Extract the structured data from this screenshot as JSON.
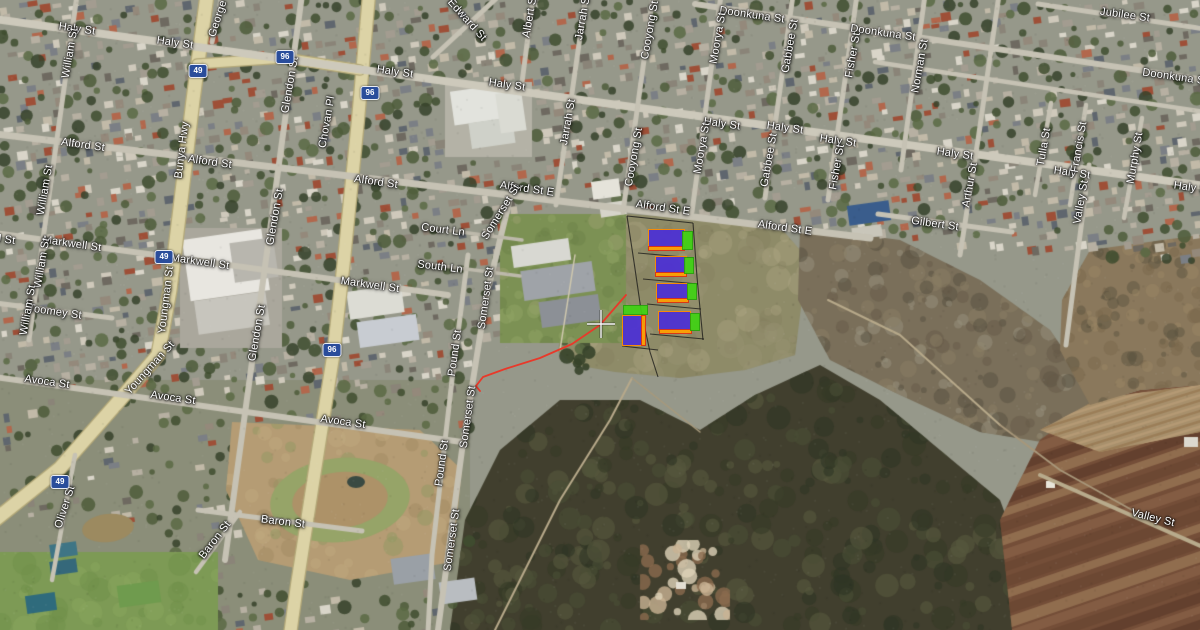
{
  "map": {
    "view": "satellite",
    "street_labels": [
      {
        "text": "Haly St",
        "x": 77,
        "y": 29,
        "rot": 8
      },
      {
        "text": "Haly St",
        "x": 175,
        "y": 43,
        "rot": 8
      },
      {
        "text": "Haly St",
        "x": 395,
        "y": 72,
        "rot": 8
      },
      {
        "text": "Haly St",
        "x": 507,
        "y": 85,
        "rot": 8
      },
      {
        "text": "Haly St",
        "x": 722,
        "y": 124,
        "rot": 8
      },
      {
        "text": "Haly St",
        "x": 785,
        "y": 128,
        "rot": 8
      },
      {
        "text": "Haly St",
        "x": 838,
        "y": 141,
        "rot": 8
      },
      {
        "text": "Haly St",
        "x": 955,
        "y": 154,
        "rot": 8
      },
      {
        "text": "Haly St",
        "x": 1072,
        "y": 173,
        "rot": 8
      },
      {
        "text": "Haly St",
        "x": 1192,
        "y": 188,
        "rot": 8
      },
      {
        "text": "Alford St",
        "x": 83,
        "y": 145,
        "rot": 8
      },
      {
        "text": "Alford St",
        "x": 210,
        "y": 162,
        "rot": 8
      },
      {
        "text": "Alford St",
        "x": 376,
        "y": 182,
        "rot": 8
      },
      {
        "text": "Alford St E",
        "x": 527,
        "y": 189,
        "rot": 8
      },
      {
        "text": "Alford St E",
        "x": 663,
        "y": 208,
        "rot": 8
      },
      {
        "text": "Alford St E",
        "x": 785,
        "y": 228,
        "rot": 8
      },
      {
        "text": "Markwell St",
        "x": -14,
        "y": 237,
        "rot": 8
      },
      {
        "text": "Markwell St",
        "x": 72,
        "y": 244,
        "rot": 8
      },
      {
        "text": "Markwell St",
        "x": 200,
        "y": 262,
        "rot": 8
      },
      {
        "text": "Markwell St",
        "x": 370,
        "y": 285,
        "rot": 8
      },
      {
        "text": "Avoca St",
        "x": 47,
        "y": 382,
        "rot": 8
      },
      {
        "text": "Avoca St",
        "x": 173,
        "y": 398,
        "rot": 8
      },
      {
        "text": "Avoca St",
        "x": 343,
        "y": 422,
        "rot": 8
      },
      {
        "text": "Doonkuna St",
        "x": 752,
        "y": 15,
        "rot": 8
      },
      {
        "text": "Doonkuna St",
        "x": 883,
        "y": 33,
        "rot": 8
      },
      {
        "text": "Doonkuna St",
        "x": 1175,
        "y": 77,
        "rot": 8
      },
      {
        "text": "Jubilee St",
        "x": 1125,
        "y": 15,
        "rot": 8
      },
      {
        "text": "Gilbert St",
        "x": 935,
        "y": 224,
        "rot": 8
      },
      {
        "text": "Court Ln",
        "x": 443,
        "y": 230,
        "rot": 7
      },
      {
        "text": "South Ln",
        "x": 440,
        "y": 267,
        "rot": 7
      },
      {
        "text": "Toomey St",
        "x": 55,
        "y": 312,
        "rot": 8
      },
      {
        "text": "Baron St",
        "x": 283,
        "y": 522,
        "rot": 7
      },
      {
        "text": "Baron St",
        "x": 215,
        "y": 540,
        "rot": -52
      },
      {
        "text": "William St",
        "x": 70,
        "y": 53,
        "rot": -80
      },
      {
        "text": "William St",
        "x": 45,
        "y": 190,
        "rot": -80
      },
      {
        "text": "William St",
        "x": 42,
        "y": 263,
        "rot": -80
      },
      {
        "text": "William St",
        "x": 28,
        "y": 310,
        "rot": -80
      },
      {
        "text": "Glendon St",
        "x": 290,
        "y": 85,
        "rot": -80
      },
      {
        "text": "Glendon St",
        "x": 275,
        "y": 217,
        "rot": -80
      },
      {
        "text": "Glendon St",
        "x": 257,
        "y": 333,
        "rot": -80
      },
      {
        "text": "Chovan Pl",
        "x": 327,
        "y": 122,
        "rot": -80
      },
      {
        "text": "Somerset St",
        "x": 501,
        "y": 212,
        "rot": -58
      },
      {
        "text": "Somerset St",
        "x": 486,
        "y": 298,
        "rot": -82
      },
      {
        "text": "Somerset St",
        "x": 468,
        "y": 417,
        "rot": -82
      },
      {
        "text": "Somerset St",
        "x": 452,
        "y": 540,
        "rot": -82
      },
      {
        "text": "Pound St",
        "x": 455,
        "y": 353,
        "rot": -82
      },
      {
        "text": "Pound St",
        "x": 442,
        "y": 463,
        "rot": -82
      },
      {
        "text": "Oliver St",
        "x": 65,
        "y": 507,
        "rot": -72
      },
      {
        "text": "Albert St",
        "x": 530,
        "y": 16,
        "rot": -80
      },
      {
        "text": "Jarrah St",
        "x": 583,
        "y": 17,
        "rot": -80
      },
      {
        "text": "Jarrah St",
        "x": 568,
        "y": 122,
        "rot": -80
      },
      {
        "text": "Cooyong St",
        "x": 650,
        "y": 30,
        "rot": -80
      },
      {
        "text": "Cooyong St",
        "x": 634,
        "y": 157,
        "rot": -80
      },
      {
        "text": "Moorya St",
        "x": 718,
        "y": 38,
        "rot": -80
      },
      {
        "text": "Moorya St",
        "x": 702,
        "y": 148,
        "rot": -80
      },
      {
        "text": "Gabbee St",
        "x": 790,
        "y": 46,
        "rot": -80
      },
      {
        "text": "Gabbee St",
        "x": 769,
        "y": 160,
        "rot": -80
      },
      {
        "text": "Fisher St",
        "x": 853,
        "y": 55,
        "rot": -80
      },
      {
        "text": "Fisher St",
        "x": 837,
        "y": 167,
        "rot": -80
      },
      {
        "text": "Norman St",
        "x": 920,
        "y": 66,
        "rot": -80
      },
      {
        "text": "Arthur St",
        "x": 970,
        "y": 185,
        "rot": -80
      },
      {
        "text": "Tulla St",
        "x": 1044,
        "y": 147,
        "rot": -80
      },
      {
        "text": "Francis St",
        "x": 1079,
        "y": 147,
        "rot": -80
      },
      {
        "text": "Murphy St",
        "x": 1135,
        "y": 158,
        "rot": -80
      },
      {
        "text": "Valley St",
        "x": 1081,
        "y": 202,
        "rot": -80
      },
      {
        "text": "Valley St",
        "x": 1153,
        "y": 518,
        "rot": 14
      },
      {
        "text": "Edward St",
        "x": 467,
        "y": 20,
        "rot": 48
      },
      {
        "text": "George St",
        "x": 220,
        "y": 12,
        "rot": -72
      },
      {
        "text": "Bunya Hwy",
        "x": 182,
        "y": 150,
        "rot": -83
      },
      {
        "text": "Youngman St",
        "x": 166,
        "y": 300,
        "rot": -83
      },
      {
        "text": "Youngman St",
        "x": 150,
        "y": 368,
        "rot": -48
      }
    ],
    "route_shields": [
      {
        "number": "49",
        "x": 198,
        "y": 71
      },
      {
        "number": "49",
        "x": 164,
        "y": 257
      },
      {
        "number": "49",
        "x": 60,
        "y": 482
      },
      {
        "number": "96",
        "x": 285,
        "y": 57
      },
      {
        "number": "96",
        "x": 370,
        "y": 93
      },
      {
        "number": "96",
        "x": 332,
        "y": 350
      }
    ],
    "overlay": {
      "colors": {
        "purple": "#4b2fd6",
        "green": "#3fd313",
        "orange": "#ffa000",
        "purple_stroke": "#ff8c00",
        "green_stroke": "#27a30a",
        "orange_stroke": "#e03010",
        "red_line": "#e8392a",
        "boundary": "#151515"
      },
      "lots": [
        {
          "kind": "purple",
          "x": 648,
          "y": 229,
          "w": 37,
          "h": 19
        },
        {
          "kind": "orange",
          "x": 648,
          "y": 246,
          "w": 37,
          "h": 5
        },
        {
          "kind": "green",
          "x": 682,
          "y": 231,
          "w": 11,
          "h": 19
        },
        {
          "kind": "purple",
          "x": 655,
          "y": 256,
          "w": 32,
          "h": 18
        },
        {
          "kind": "orange",
          "x": 655,
          "y": 272,
          "w": 32,
          "h": 5
        },
        {
          "kind": "green",
          "x": 684,
          "y": 257,
          "w": 10,
          "h": 17
        },
        {
          "kind": "purple",
          "x": 656,
          "y": 283,
          "w": 32,
          "h": 17
        },
        {
          "kind": "orange",
          "x": 657,
          "y": 298,
          "w": 32,
          "h": 5
        },
        {
          "kind": "green",
          "x": 687,
          "y": 283,
          "w": 10,
          "h": 17
        },
        {
          "kind": "green",
          "x": 623,
          "y": 305,
          "w": 25,
          "h": 10
        },
        {
          "kind": "purple",
          "x": 622,
          "y": 315,
          "w": 20,
          "h": 31
        },
        {
          "kind": "orange",
          "x": 641,
          "y": 315,
          "w": 5,
          "h": 31
        },
        {
          "kind": "purple",
          "x": 658,
          "y": 311,
          "w": 33,
          "h": 20
        },
        {
          "kind": "orange",
          "x": 659,
          "y": 329,
          "w": 33,
          "h": 5
        },
        {
          "kind": "green",
          "x": 690,
          "y": 313,
          "w": 10,
          "h": 18
        }
      ],
      "boundary_lines": [
        "627,216 634,262 641,310 650,352 658,377",
        "627,216 693,223",
        "693,223 697,277 703,340",
        "638,253 694,258",
        "643,279 698,284",
        "647,304 701,309",
        "650,334 704,339",
        "622,346 658,350"
      ],
      "red_path": "626,295 600,325 572,344 540,358 505,369 483,377 476,386 480,391",
      "crosshair": {
        "x": 601,
        "y": 324
      }
    }
  }
}
